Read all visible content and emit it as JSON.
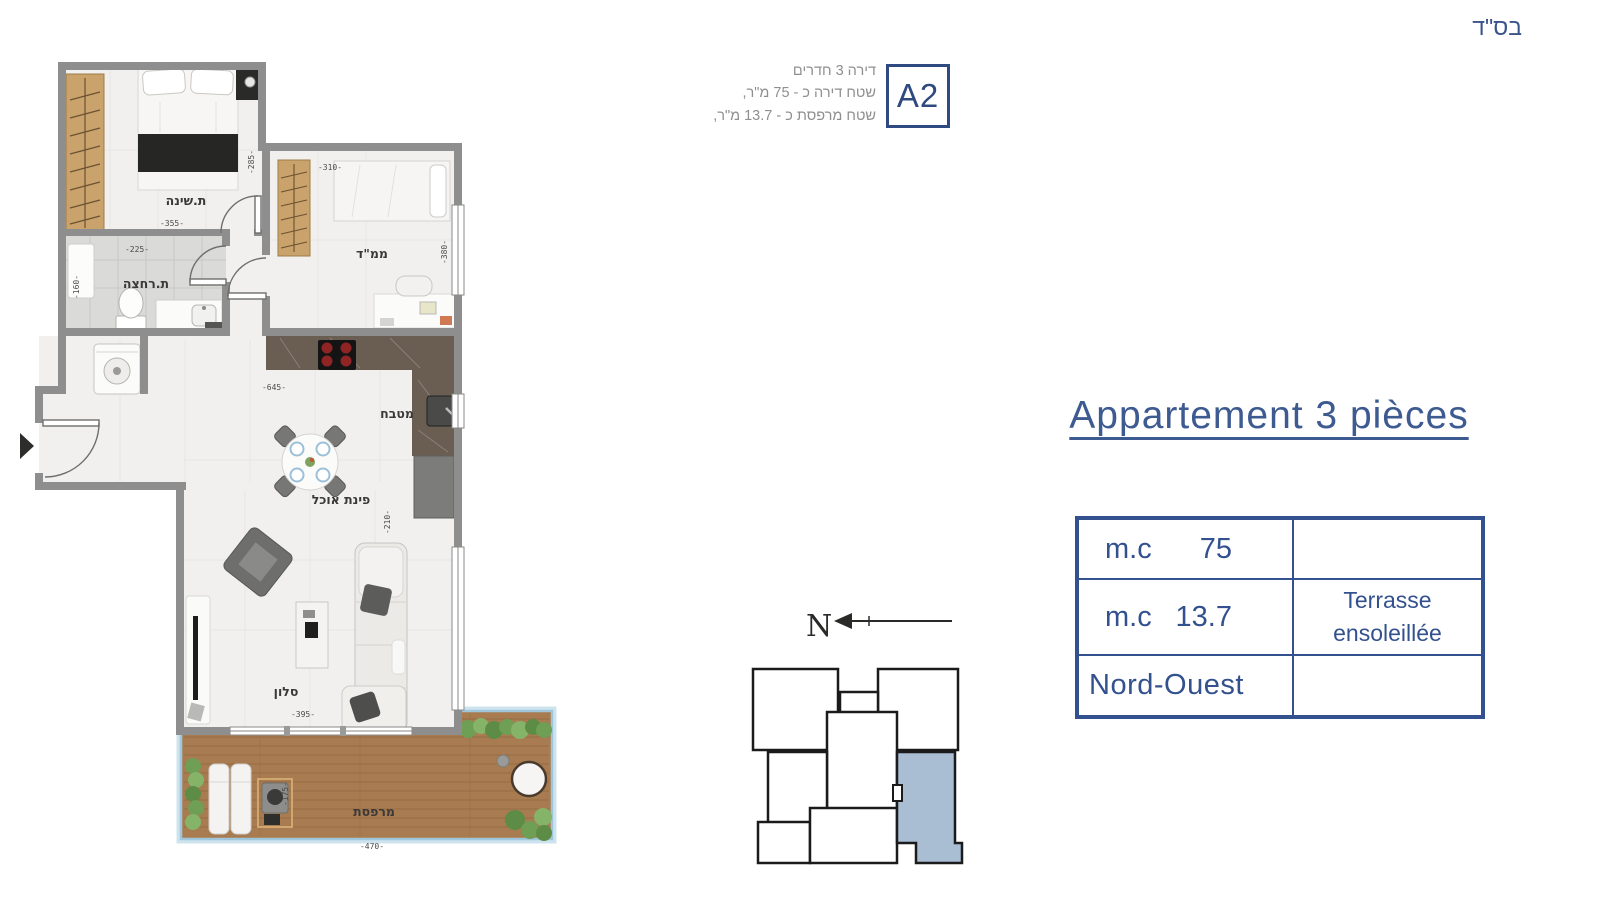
{
  "page": {
    "bsd": "בס\"ד"
  },
  "header": {
    "info_lines": [
      "דירה 3 חדרים",
      "שטח דירה כ - 75 מ\"ר,",
      "שטח מרפסת כ - 13.7 מ\"ר,"
    ],
    "unit_code": "A2"
  },
  "right_panel": {
    "title": "Appartement 3 pièces",
    "table": {
      "rows": [
        {
          "label": "m.c",
          "value": "75",
          "note": ""
        },
        {
          "label": "m.c",
          "value": "13.7",
          "note_line1": "Terrasse",
          "note_line2": "ensoleillée"
        },
        {
          "label": "Nord-Ouest",
          "value": "",
          "note": ""
        }
      ]
    }
  },
  "compass": {
    "north_label": "N"
  },
  "floorplan": {
    "labels": {
      "bedroom": "ת.שינה",
      "safe_room": "ממ\"ד",
      "bathroom": "ת.רחצה",
      "kitchen": "מטבח",
      "dining": "פינת אוכל",
      "living": "סלון",
      "terrace": "מרפסת"
    },
    "dimensions": {
      "bedroom_width": "-355-",
      "bedroom_height": "-285-",
      "safe_room_width": "-310-",
      "safe_room_height": "-380-",
      "bathroom_width": "-225-",
      "bathroom_height": "-160-",
      "kitchen_width": "-645-",
      "living_height": "-210-",
      "living_width": "-395-",
      "terrace_height": "-175-",
      "terrace_width": "-470-"
    },
    "colors": {
      "accent_blue": "#33518e",
      "wall_gray": "#8e8e8e",
      "keyplan_unit_blue": "#a9bdd3",
      "wood": "#c9a26c",
      "deck": "#a87c50",
      "railing_blue": "#9fc6da"
    }
  }
}
